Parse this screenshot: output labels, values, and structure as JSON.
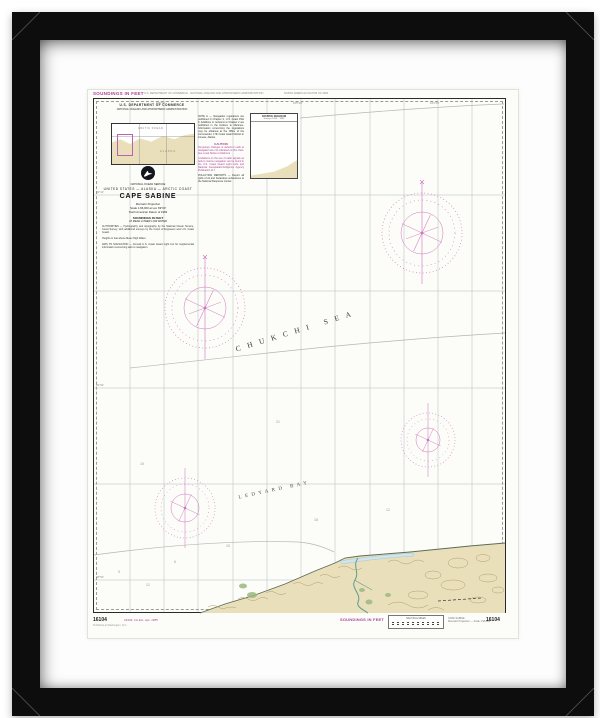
{
  "artwork": {
    "kind": "Framed nautical chart print",
    "chart_number": "16104",
    "title": "CAPE SABINE"
  },
  "colors": {
    "frame": "#0d0d0d",
    "mat": "#fdfdfd",
    "paper": "#fcfcf8",
    "noaa_magenta": "#a8449c",
    "compass_rose": "#cf74bf",
    "land_tan": "#e9e0bb",
    "contour_brown": "#b59c6c"
  },
  "margins": {
    "top_left": "SOUNDINGS IN FEET",
    "top_center": "U.S. DEPARTMENT OF COMMERCE · NATIONAL OCEANIC AND ATMOSPHERIC ADMINISTRATION",
    "top_right": "NORTH AMERICAN DATUM OF 1983",
    "bottom_left_number": "16104",
    "bottom_left_note": "Published at Washington, D.C.",
    "bottom_edition": "16104, 1st Ed., Apr. 1985",
    "bottom_center": "SOUNDINGS IN FEET",
    "scale_box_title": "NAUTICAL MILES",
    "bottom_right_line1": "CAPE SABINE",
    "bottom_right_line2": "Mercator Projection — Scale 1:96,000",
    "bottom_right_number": "16104"
  },
  "header": {
    "dept": "U.S. DEPARTMENT OF COMMERCE",
    "agency": "NATIONAL OCEANIC AND ATMOSPHERIC ADMINISTRATION"
  },
  "title_block": {
    "line_service": "NATIONAL OCEAN SERVICE",
    "line_region": "UNITED STATES — ALASKA — ARCTIC COAST",
    "title": "CAPE SABINE",
    "projection": "Mercator Projection",
    "scale": "Scale 1:96,000 at Lat. 69°00'",
    "datum": "North American Datum of 1983",
    "soundings": "SOUNDINGS IN FEET",
    "tide": "AT MEAN LOWER LOW WATER",
    "para_authorities": "AUTHORITIES — Hydrography and topography by the National Ocean Service, Coast Survey, with additional surveys by the Corps of Engineers and U.S. Coast Guard.",
    "para_heights": "Heights in feet above Mean High Water.",
    "para_aids": "AIDS TO NAVIGATION — Consult U.S. Coast Guard Light List for supplemental information concerning aids to navigation."
  },
  "notes": {
    "note_a": "NOTE A — Navigation regulations are published in Chapter 2, U.S. Coast Pilot 9. Additions or revisions to Chapter 2 are published in the Notices to Mariners. Information concerning the regulations may be obtained at the Office of the Commander, 17th Coast Guard District in Juneau, Alaska.",
    "caution_heading": "CAUTION",
    "caution_text": "Temporary changes or defects in aids to navigation are not indicated on this chart. See Local Notice to Mariners.",
    "caution2_text": "Limitations on the use of radio signals as aids to marine navigation can be found in the U.S. Coast Guard Light Lists and National Geospatial-Intelligence Agency Publication 117.",
    "pollution": "POLLUTION REPORTS — Report all spills of oil and hazardous substances to the National Response Center."
  },
  "inset": {
    "water_label": "ARCTIC OCEAN",
    "land_label": "ALASKA"
  },
  "source_diagram": {
    "title": "SOURCE DIAGRAM",
    "subtitle": "Surveys 1950 – 1984"
  },
  "sea_labels": {
    "sea": "CHUKCHI SEA",
    "bay": "LEDYARD BAY"
  },
  "graticule": {
    "top": [
      "165°30'",
      "165°00'",
      "164°30'"
    ],
    "left": [
      "69°10'",
      "69°00'",
      "68°50'"
    ]
  },
  "soundings": [
    "9",
    "12",
    "6",
    "15",
    "18",
    "12",
    "21",
    "15"
  ]
}
